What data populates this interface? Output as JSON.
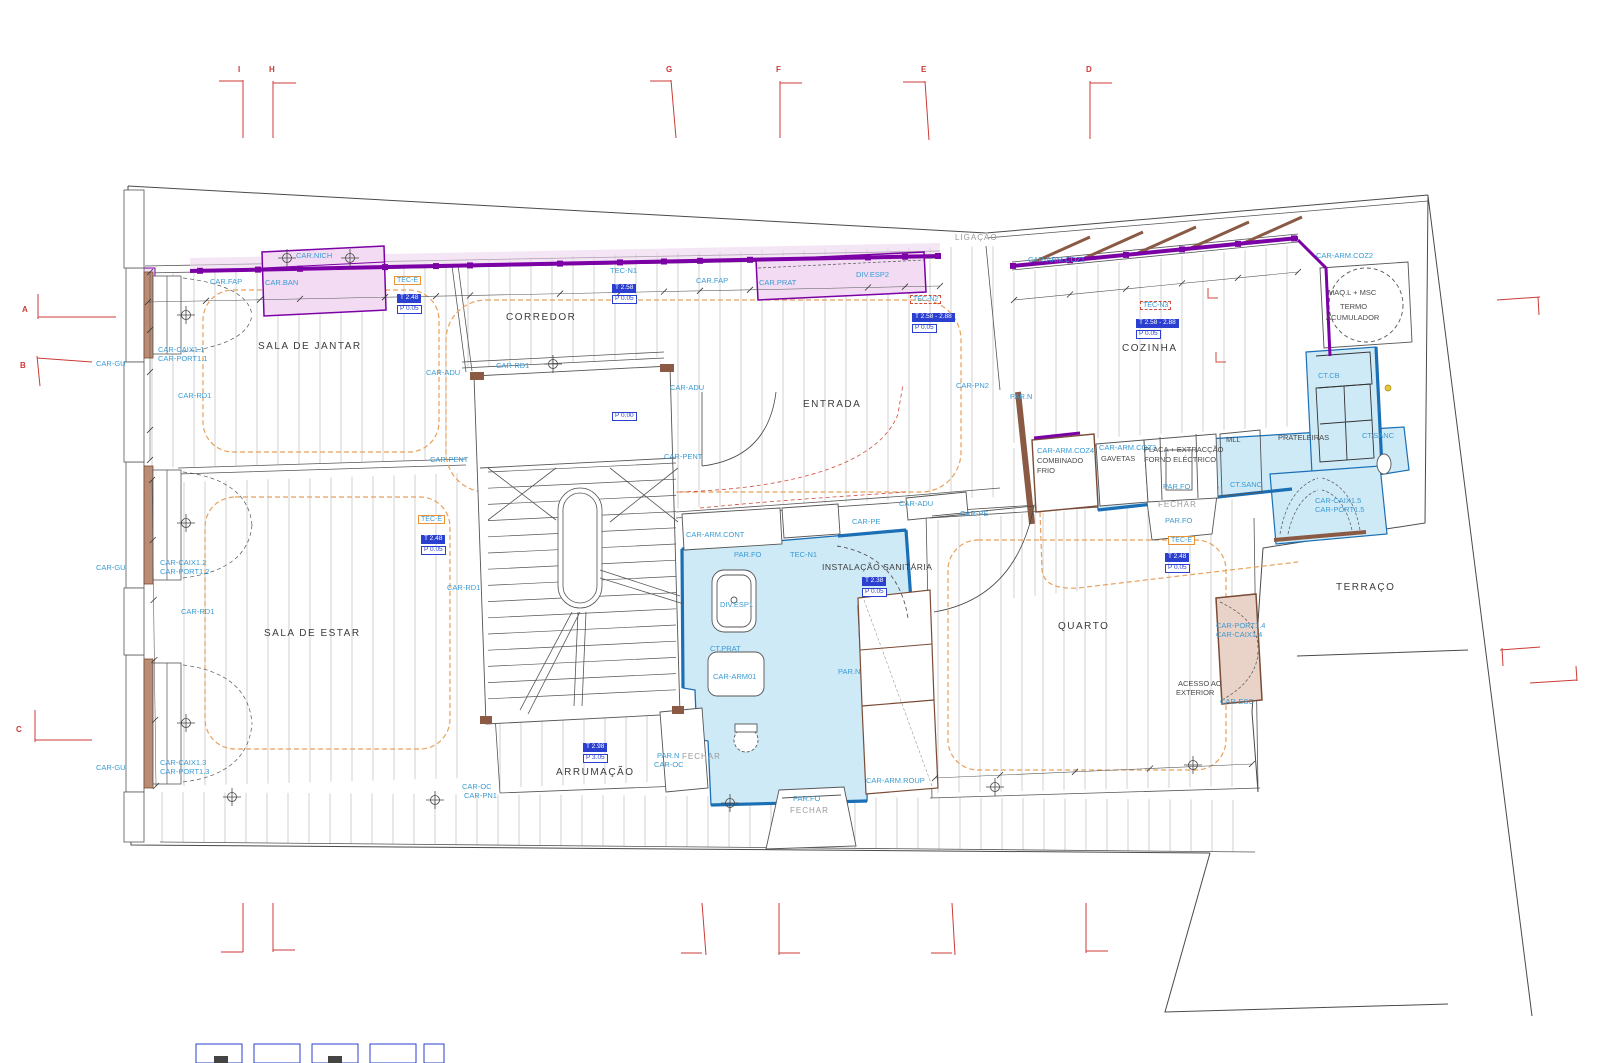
{
  "colors": {
    "joinery_purple": "#7b00a5",
    "joinery_lilac": "#f2dbf3",
    "wet_zone_fill": "#cfeaf7",
    "wet_zone_border": "#1a6fb5",
    "wall_brown": "#8a5a44",
    "door_tan": "#e9d2c8",
    "floor_outline_orange": "#e8a05c",
    "grid_marker_red": "#cc3a35",
    "value_box_blue": "#2b3fd1",
    "annotation_blue": "#3a9bd5",
    "tec_box_orange": "#e8923a"
  },
  "labels": [
    {
      "t": "I",
      "x": 238,
      "y": 66,
      "c": "red"
    },
    {
      "t": "H",
      "x": 269,
      "y": 66,
      "c": "red"
    },
    {
      "t": "G",
      "x": 666,
      "y": 66,
      "c": "red"
    },
    {
      "t": "F",
      "x": 776,
      "y": 66,
      "c": "red"
    },
    {
      "t": "E",
      "x": 921,
      "y": 66,
      "c": "red"
    },
    {
      "t": "D",
      "x": 1086,
      "y": 66,
      "c": "red"
    },
    {
      "t": "A",
      "x": 22,
      "y": 306,
      "c": "red"
    },
    {
      "t": "B",
      "x": 20,
      "y": 362,
      "c": "red"
    },
    {
      "t": "C",
      "x": 16,
      "y": 726,
      "c": "red"
    },
    {
      "t": "CAR.NICH",
      "x": 296,
      "y": 252,
      "c": "lbl"
    },
    {
      "t": "CAR.FAP",
      "x": 210,
      "y": 278,
      "c": "lbl"
    },
    {
      "t": "CAR.BAN",
      "x": 265,
      "y": 279,
      "c": "lbl"
    },
    {
      "t": "TEC-E",
      "x": 394,
      "y": 276,
      "c": "tece"
    },
    {
      "t": "T 2.48",
      "x": 397,
      "y": 294,
      "c": "tbox"
    },
    {
      "t": "P 0.05",
      "x": 397,
      "y": 305,
      "c": "pbox"
    },
    {
      "t": "CORREDOR",
      "x": 506,
      "y": 313,
      "c": "room"
    },
    {
      "t": "TEC-N1",
      "x": 610,
      "y": 267,
      "c": "lbl"
    },
    {
      "t": "T 2.58",
      "x": 612,
      "y": 284,
      "c": "tbox"
    },
    {
      "t": "P 0.05",
      "x": 612,
      "y": 295,
      "c": "pbox"
    },
    {
      "t": "CAR.FAP",
      "x": 696,
      "y": 277,
      "c": "lbl"
    },
    {
      "t": "CAR.PRAT",
      "x": 759,
      "y": 279,
      "c": "lbl"
    },
    {
      "t": "DIV.ESP2",
      "x": 856,
      "y": 271,
      "c": "lbl"
    },
    {
      "t": "LIGAÇÃO",
      "x": 955,
      "y": 234,
      "c": "gray"
    },
    {
      "t": "TEC-N2",
      "x": 910,
      "y": 295,
      "c": "tecn"
    },
    {
      "t": "T 2.58 - 2.88",
      "x": 912,
      "y": 313,
      "c": "tbox"
    },
    {
      "t": "P 0.05",
      "x": 912,
      "y": 324,
      "c": "pbox"
    },
    {
      "t": "CAR-ARM.COZ1",
      "x": 1028,
      "y": 256,
      "c": "lbl"
    },
    {
      "t": "CAR-ARM.COZ2",
      "x": 1316,
      "y": 252,
      "c": "lbl"
    },
    {
      "t": "MAQ.L + MSC",
      "x": 1328,
      "y": 289,
      "c": "blk"
    },
    {
      "t": "TERMO",
      "x": 1340,
      "y": 303,
      "c": "blk"
    },
    {
      "t": "ACUMULADOR",
      "x": 1326,
      "y": 314,
      "c": "blk"
    },
    {
      "t": "TEC-N3",
      "x": 1140,
      "y": 301,
      "c": "tecn"
    },
    {
      "t": "T 2.58 - 2.88",
      "x": 1136,
      "y": 319,
      "c": "tbox"
    },
    {
      "t": "P 0.05",
      "x": 1136,
      "y": 330,
      "c": "pbox"
    },
    {
      "t": "COZINHA",
      "x": 1122,
      "y": 344,
      "c": "room"
    },
    {
      "t": "SALA DE JANTAR",
      "x": 258,
      "y": 342,
      "c": "room"
    },
    {
      "t": "CAR-CAIX1.1",
      "x": 158,
      "y": 346,
      "c": "lbl"
    },
    {
      "t": "CAR-PORT1.1",
      "x": 158,
      "y": 355,
      "c": "lbl"
    },
    {
      "t": "CAR-GU",
      "x": 96,
      "y": 360,
      "c": "lbl"
    },
    {
      "t": "CAR-RD1",
      "x": 178,
      "y": 392,
      "c": "lbl"
    },
    {
      "t": "CAR-ADU",
      "x": 426,
      "y": 369,
      "c": "lbl"
    },
    {
      "t": "CAR-RD1",
      "x": 496,
      "y": 362,
      "c": "lbl"
    },
    {
      "t": "CAR-ADU",
      "x": 670,
      "y": 384,
      "c": "lbl"
    },
    {
      "t": "ENTRADA",
      "x": 803,
      "y": 400,
      "c": "room"
    },
    {
      "t": "CAR-PN2",
      "x": 956,
      "y": 382,
      "c": "lbl"
    },
    {
      "t": "PAR.N",
      "x": 1010,
      "y": 393,
      "c": "lbl"
    },
    {
      "t": "CT.CB",
      "x": 1318,
      "y": 372,
      "c": "lbl"
    },
    {
      "t": "CAR-PENT",
      "x": 430,
      "y": 456,
      "c": "lbl"
    },
    {
      "t": "CAR-PENT",
      "x": 664,
      "y": 453,
      "c": "lbl"
    },
    {
      "t": "P 0.00",
      "x": 612,
      "y": 412,
      "c": "pbox"
    },
    {
      "t": "CAR-ARM.CONT",
      "x": 686,
      "y": 531,
      "c": "lbl"
    },
    {
      "t": "CAR-PE",
      "x": 852,
      "y": 518,
      "c": "lbl"
    },
    {
      "t": "CAR-ADU",
      "x": 899,
      "y": 500,
      "c": "lbl"
    },
    {
      "t": "CAR-PE",
      "x": 960,
      "y": 510,
      "c": "lbl"
    },
    {
      "t": "CAR-ARM.COZ4",
      "x": 1037,
      "y": 447,
      "c": "lbl"
    },
    {
      "t": "COMBINADO",
      "x": 1037,
      "y": 457,
      "c": "blk"
    },
    {
      "t": "FRIO",
      "x": 1037,
      "y": 467,
      "c": "blk"
    },
    {
      "t": "CAR-ARM.COZ3",
      "x": 1099,
      "y": 444,
      "c": "lbl"
    },
    {
      "t": "GAVETAS",
      "x": 1101,
      "y": 455,
      "c": "blk"
    },
    {
      "t": "PLACA + EXTRACÇÃO",
      "x": 1144,
      "y": 446,
      "c": "blk"
    },
    {
      "t": "FORNO ELÉCTRICO",
      "x": 1144,
      "y": 456,
      "c": "blk"
    },
    {
      "t": "MLL",
      "x": 1226,
      "y": 436,
      "c": "blk"
    },
    {
      "t": "PRATELEIRAS",
      "x": 1278,
      "y": 434,
      "c": "blk"
    },
    {
      "t": "CT.SANC",
      "x": 1362,
      "y": 432,
      "c": "lbl"
    },
    {
      "t": "PAR.FO",
      "x": 1163,
      "y": 483,
      "c": "lbl"
    },
    {
      "t": "FECHAR",
      "x": 1158,
      "y": 501,
      "c": "gray"
    },
    {
      "t": "CT.SANC",
      "x": 1230,
      "y": 481,
      "c": "lbl"
    },
    {
      "t": "CAR-CAIX1.5",
      "x": 1315,
      "y": 497,
      "c": "lbl"
    },
    {
      "t": "CAR-PORT1.5",
      "x": 1315,
      "y": 506,
      "c": "lbl"
    },
    {
      "t": "PAR.FO",
      "x": 1165,
      "y": 517,
      "c": "lbl"
    },
    {
      "t": "TEC-E",
      "x": 1168,
      "y": 536,
      "c": "tece"
    },
    {
      "t": "T 2.48",
      "x": 1165,
      "y": 553,
      "c": "tbox"
    },
    {
      "t": "P 0.05",
      "x": 1165,
      "y": 564,
      "c": "pbox"
    },
    {
      "t": "PAR.FO",
      "x": 734,
      "y": 551,
      "c": "lbl"
    },
    {
      "t": "TEC-N1",
      "x": 790,
      "y": 551,
      "c": "lbl"
    },
    {
      "t": "INSTALAÇÃO SANITÁRIA",
      "x": 822,
      "y": 563,
      "c": "roomsm"
    },
    {
      "t": "T 2.38",
      "x": 862,
      "y": 577,
      "c": "tbox"
    },
    {
      "t": "P 0.05",
      "x": 862,
      "y": 588,
      "c": "pbox"
    },
    {
      "t": "DIV.ESP1",
      "x": 720,
      "y": 601,
      "c": "lbl"
    },
    {
      "t": "CT.PRAT",
      "x": 710,
      "y": 645,
      "c": "lbl"
    },
    {
      "t": "CAR-ARM01",
      "x": 713,
      "y": 673,
      "c": "lbl"
    },
    {
      "t": "PAR.N",
      "x": 838,
      "y": 668,
      "c": "lbl"
    },
    {
      "t": "TEC-E",
      "x": 418,
      "y": 515,
      "c": "tece"
    },
    {
      "t": "T 2.48",
      "x": 421,
      "y": 535,
      "c": "tbox"
    },
    {
      "t": "P 0.05",
      "x": 421,
      "y": 546,
      "c": "pbox"
    },
    {
      "t": "SALA DE ESTAR",
      "x": 264,
      "y": 629,
      "c": "room"
    },
    {
      "t": "CAR-RD1",
      "x": 181,
      "y": 608,
      "c": "lbl"
    },
    {
      "t": "CAR-RD1",
      "x": 447,
      "y": 584,
      "c": "lbl"
    },
    {
      "t": "CAR-GU",
      "x": 96,
      "y": 564,
      "c": "lbl"
    },
    {
      "t": "CAR-CAIX1.2",
      "x": 160,
      "y": 559,
      "c": "lbl"
    },
    {
      "t": "CAR-PORT1.2",
      "x": 160,
      "y": 568,
      "c": "lbl"
    },
    {
      "t": "QUARTO",
      "x": 1058,
      "y": 622,
      "c": "room"
    },
    {
      "t": "ACESSO AO",
      "x": 1178,
      "y": 680,
      "c": "blk"
    },
    {
      "t": "EXTERIOR",
      "x": 1176,
      "y": 689,
      "c": "blk"
    },
    {
      "t": "CAR-PORT1.4",
      "x": 1216,
      "y": 622,
      "c": "lbl"
    },
    {
      "t": "CAR-CAIX1.4",
      "x": 1216,
      "y": 631,
      "c": "lbl"
    },
    {
      "t": "CAR-ESC",
      "x": 1220,
      "y": 698,
      "c": "lbl"
    },
    {
      "t": "TERRAÇO",
      "x": 1336,
      "y": 583,
      "c": "room"
    },
    {
      "t": "T 2.98",
      "x": 583,
      "y": 743,
      "c": "tbox"
    },
    {
      "t": "P 3.05",
      "x": 583,
      "y": 754,
      "c": "pbox"
    },
    {
      "t": "ARRUMAÇÃO",
      "x": 556,
      "y": 768,
      "c": "room"
    },
    {
      "t": "PAR.N",
      "x": 657,
      "y": 752,
      "c": "lbl"
    },
    {
      "t": "CAR-OC",
      "x": 654,
      "y": 761,
      "c": "lbl"
    },
    {
      "t": "FECHAR",
      "x": 682,
      "y": 753,
      "c": "gray"
    },
    {
      "t": "CAR-GU",
      "x": 96,
      "y": 764,
      "c": "lbl"
    },
    {
      "t": "CAR-CAIX1.3",
      "x": 160,
      "y": 759,
      "c": "lbl"
    },
    {
      "t": "CAR-PORT1.3",
      "x": 160,
      "y": 768,
      "c": "lbl"
    },
    {
      "t": "CAR-OC",
      "x": 462,
      "y": 783,
      "c": "lbl"
    },
    {
      "t": "CAR-PN1",
      "x": 464,
      "y": 792,
      "c": "lbl"
    },
    {
      "t": "CAR-ARM.ROUP",
      "x": 866,
      "y": 777,
      "c": "lbl"
    },
    {
      "t": "PAR.FO",
      "x": 793,
      "y": 795,
      "c": "lbl"
    },
    {
      "t": "FECHAR",
      "x": 790,
      "y": 807,
      "c": "gray"
    }
  ]
}
